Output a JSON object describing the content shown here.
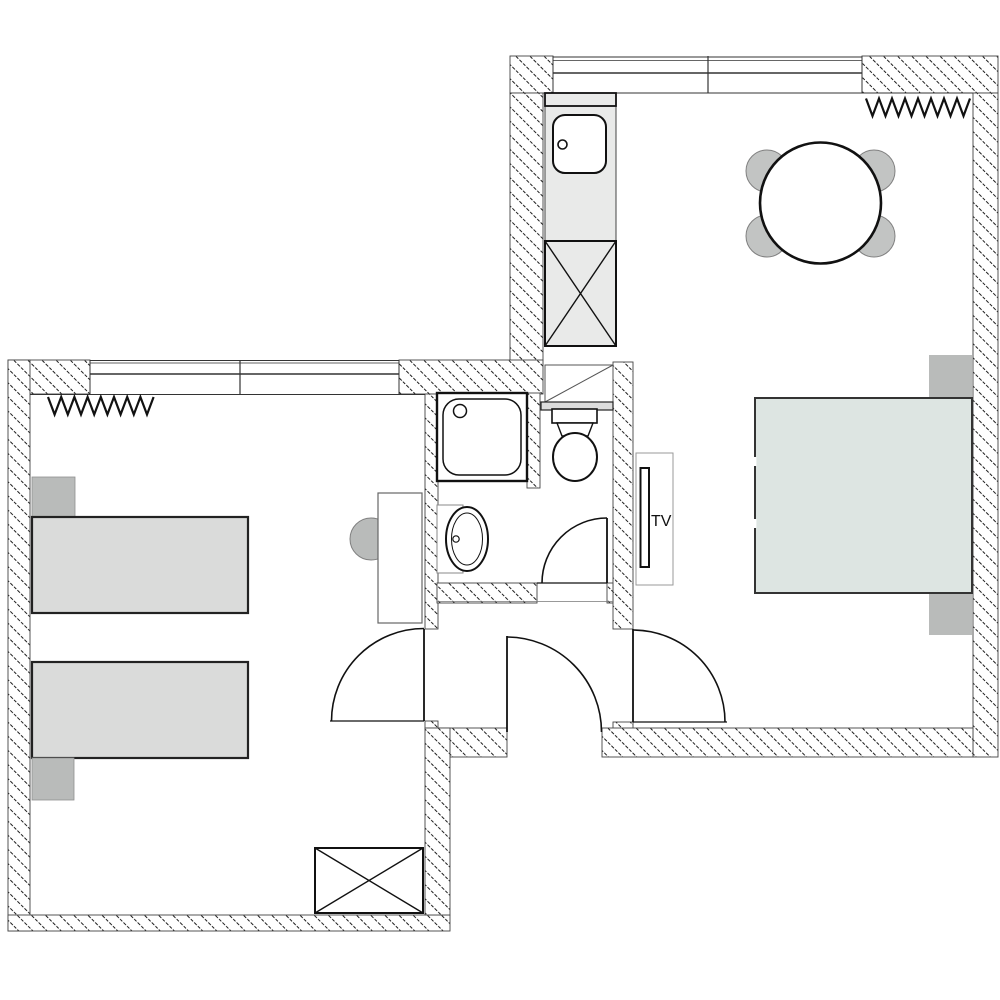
{
  "labels": {
    "tv": "TV"
  },
  "colors": {
    "background": "#ffffff",
    "wall_hatch_line": "#1c1c1c",
    "outline_dark": "#111111",
    "edge_gray": "#444444",
    "furniture_light": "#e9eae9",
    "bed_single_fill": "#dadbda",
    "soft_gray": "#b9bbba",
    "chair_gray": "#c2c4c3",
    "bed_double_fill": "#dde5e2",
    "white": "#ffffff"
  },
  "plan": {
    "type": "apartment-floor-plan",
    "rooms": {
      "kitchen_living": {
        "items": [
          "window",
          "radiator",
          "counter-with-sink",
          "tall-cabinet-crossed",
          "round-dining-table",
          "four-chairs"
        ]
      },
      "bedroom_right": {
        "items": [
          "double-bed",
          "nightstand-top",
          "nightstand-bottom",
          "wall-tv",
          "swing-door"
        ]
      },
      "bathroom": {
        "items": [
          "shower",
          "toilet",
          "wash-basin",
          "ventilation-duct",
          "swing-door"
        ]
      },
      "bedroom_left": {
        "items": [
          "window",
          "radiator",
          "single-bed-1",
          "single-bed-2",
          "pillow-1",
          "pillow-2",
          "desk",
          "desk-chair",
          "wardrobe-crossed",
          "swing-door"
        ]
      },
      "hallway": {
        "items": [
          "entry-door"
        ]
      }
    },
    "radiator_teeth": 8
  }
}
